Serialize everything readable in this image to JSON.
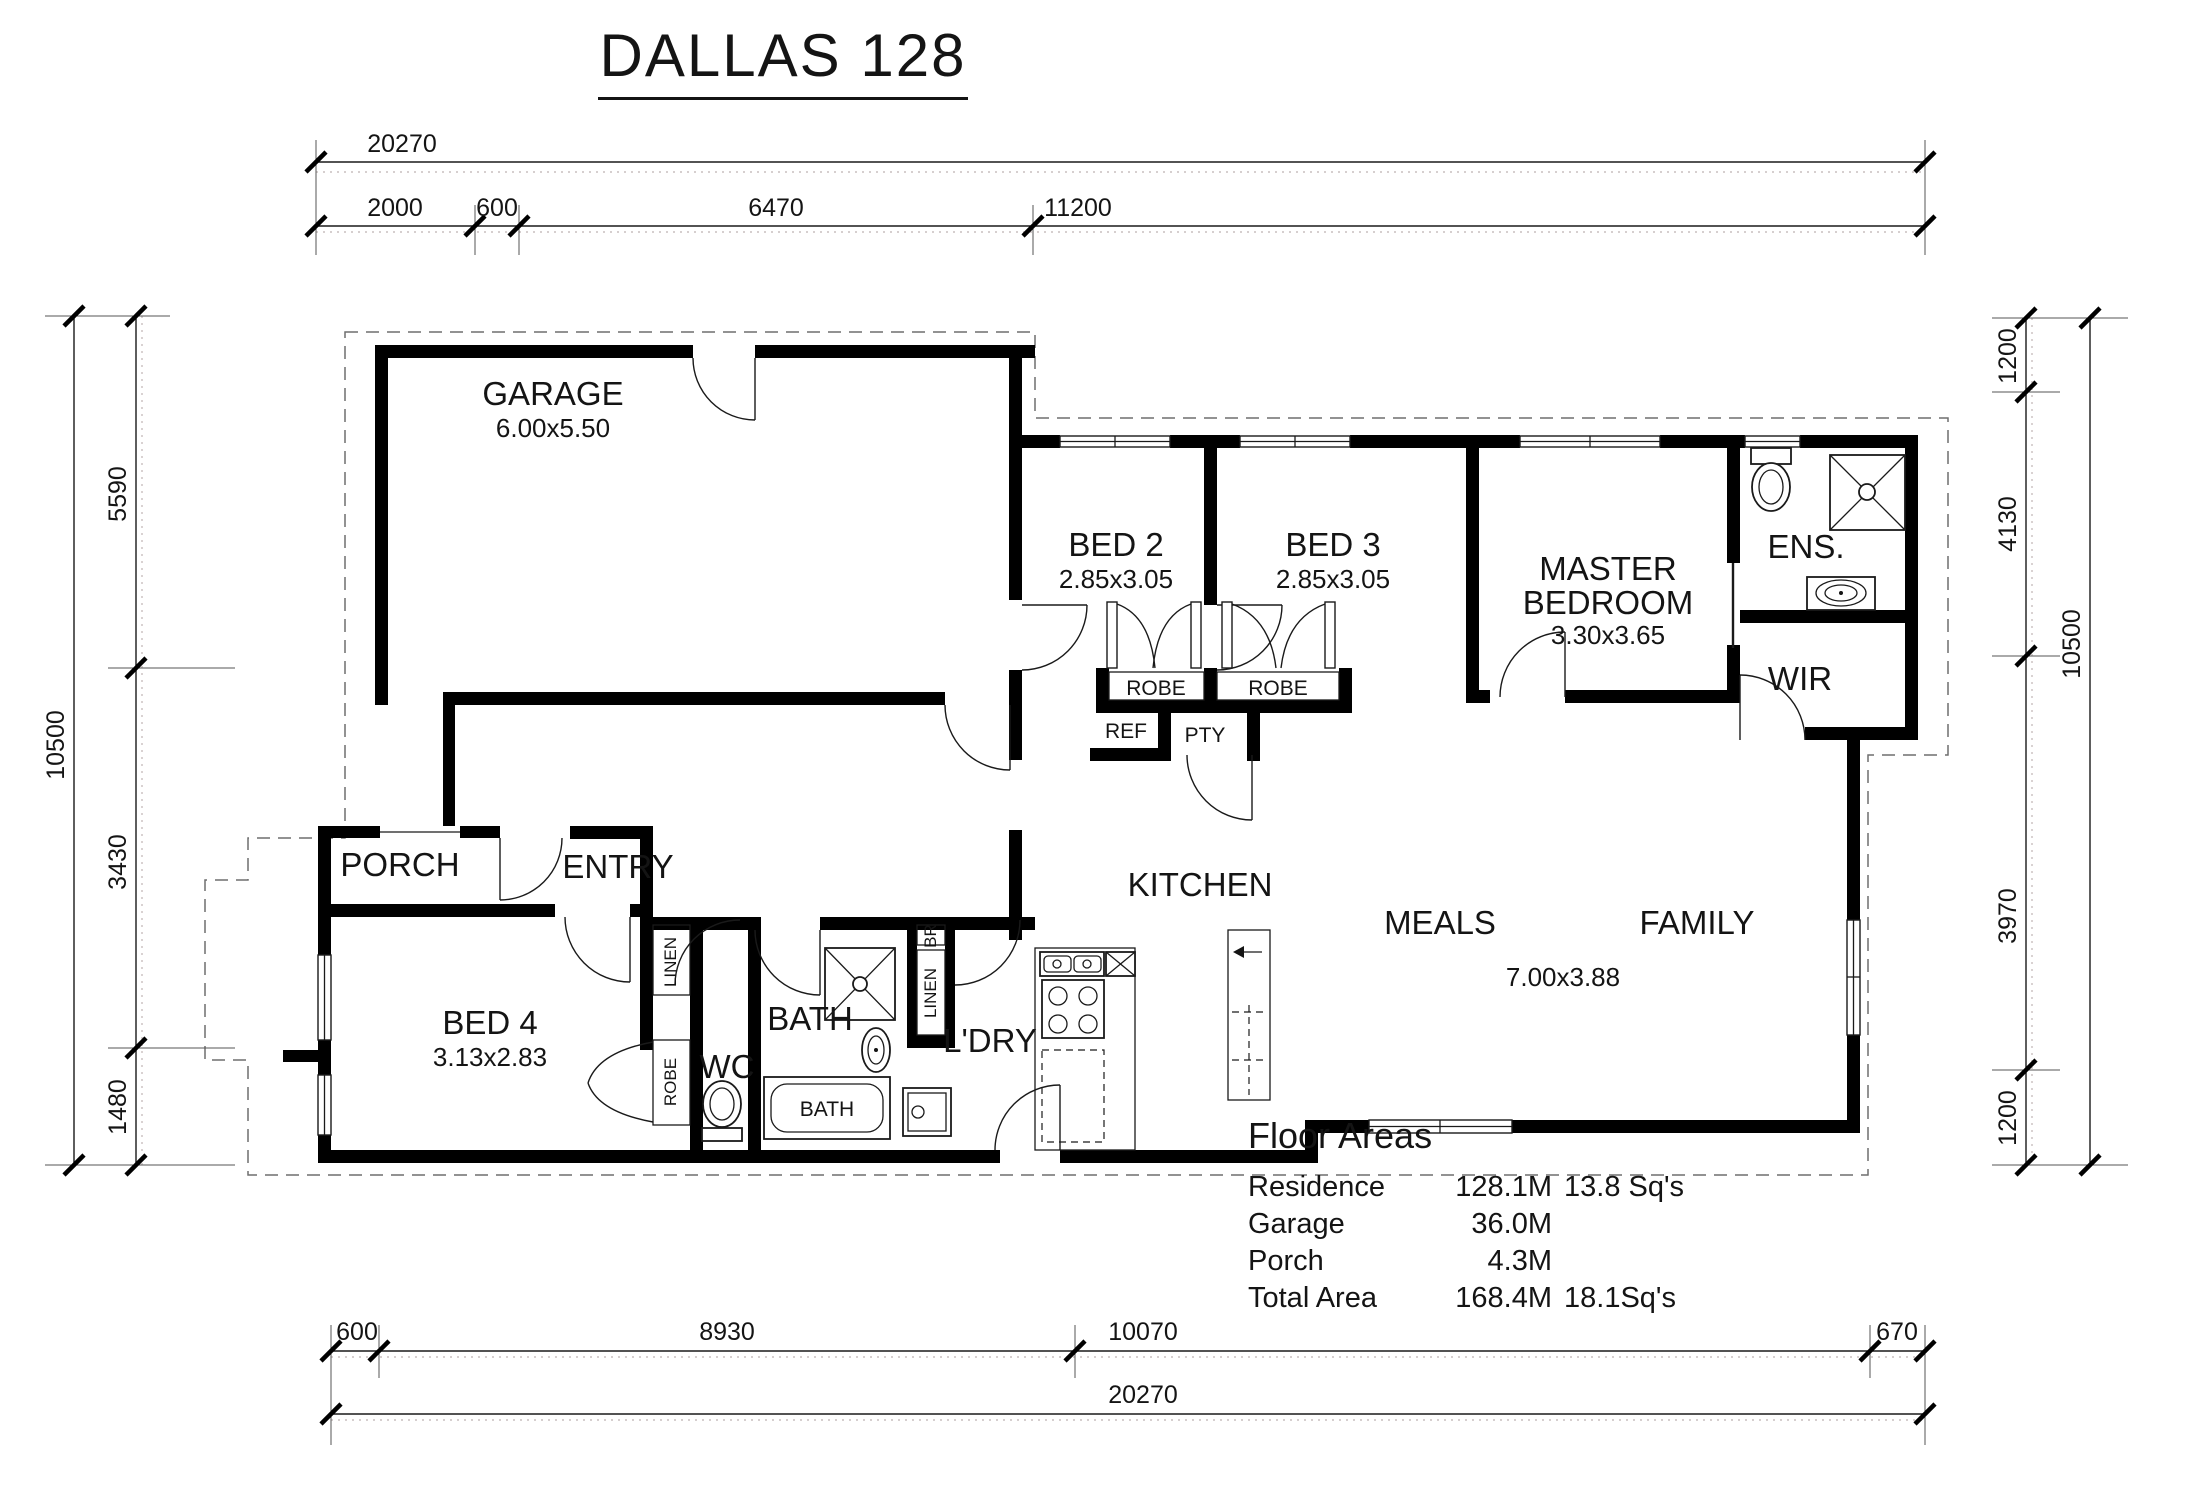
{
  "title": "DALLAS 128",
  "rooms": {
    "garage": {
      "name": "GARAGE",
      "size": "6.00x5.50"
    },
    "bed2": {
      "name": "BED 2",
      "size": "2.85x3.05"
    },
    "bed3": {
      "name": "BED 3",
      "size": "2.85x3.05"
    },
    "master": {
      "name_line1": "MASTER",
      "name_line2": "BEDROOM",
      "size": "3.30x3.65"
    },
    "ens": {
      "name": "ENS."
    },
    "wir": {
      "name": "WIR"
    },
    "porch": {
      "name": "PORCH"
    },
    "entry": {
      "name": "ENTRY"
    },
    "bed4": {
      "name": "BED 4",
      "size": "3.13x2.83"
    },
    "kitchen": {
      "name": "KITCHEN"
    },
    "meals": {
      "name": "MEALS"
    },
    "family": {
      "name": "FAMILY"
    },
    "meals_family_size": "7.00x3.88",
    "bath": {
      "name": "BATH"
    },
    "wc": {
      "name": "WC"
    },
    "ldry": {
      "name": "L'DRY"
    }
  },
  "closets": {
    "robe_bed2": "ROBE",
    "robe_bed3": "ROBE",
    "ref": "REF",
    "pty": "PTY",
    "linen_entry": "LINEN",
    "robe_bed4": "ROBE",
    "br": "BR",
    "linen_bath": "LINEN",
    "bath_tub": "BATH"
  },
  "dimensions": {
    "top_overall": "20270",
    "top_row": [
      "2000",
      "600",
      "6470",
      "11200"
    ],
    "left_outer": "10500",
    "left_row": [
      "5590",
      "3430",
      "1480"
    ],
    "right_row": [
      "1200",
      "4130",
      "3970",
      "1200"
    ],
    "right_outer": "10500",
    "bottom_row": [
      "600",
      "8930",
      "10070",
      "670"
    ],
    "bottom_overall": "20270"
  },
  "floor_areas": {
    "heading": "Floor Areas",
    "rows": [
      {
        "label": "Residence",
        "value": "128.1M",
        "squares": "13.8 Sq's"
      },
      {
        "label": "Garage",
        "value": "36.0M",
        "squares": ""
      },
      {
        "label": "Porch",
        "value": "4.3M",
        "squares": ""
      },
      {
        "label": "Total Area",
        "value": "168.4M",
        "squares": "18.1Sq's"
      }
    ]
  },
  "colors": {
    "wall": "#000000",
    "line": "#1a1a1a",
    "leader": "#c9bfbf",
    "background": "#ffffff"
  }
}
